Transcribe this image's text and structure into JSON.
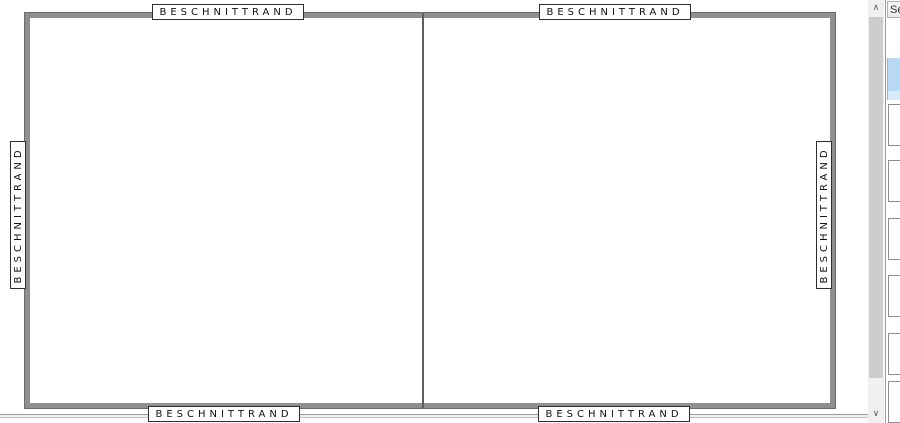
{
  "editor": {
    "bleed_label": "BESCHNITTRAND",
    "frame_color": "#8f8f8f",
    "frame_edge_color": "#6c6c6c",
    "seam_color": "#5f5f5f",
    "page_background": "#ffffff",
    "page_count": 2
  },
  "pages_panel": {
    "header_text": "Se",
    "selected_thumbnail_color": "#b7d9f3",
    "thumbnail_border_color": "#8f8f8f",
    "visible_thumbnails": 7
  },
  "scrollbar": {
    "track_color": "#f0f0f0",
    "thumb_color": "#cdcdcd",
    "up_icon": "∧",
    "down_icon": "∨"
  }
}
